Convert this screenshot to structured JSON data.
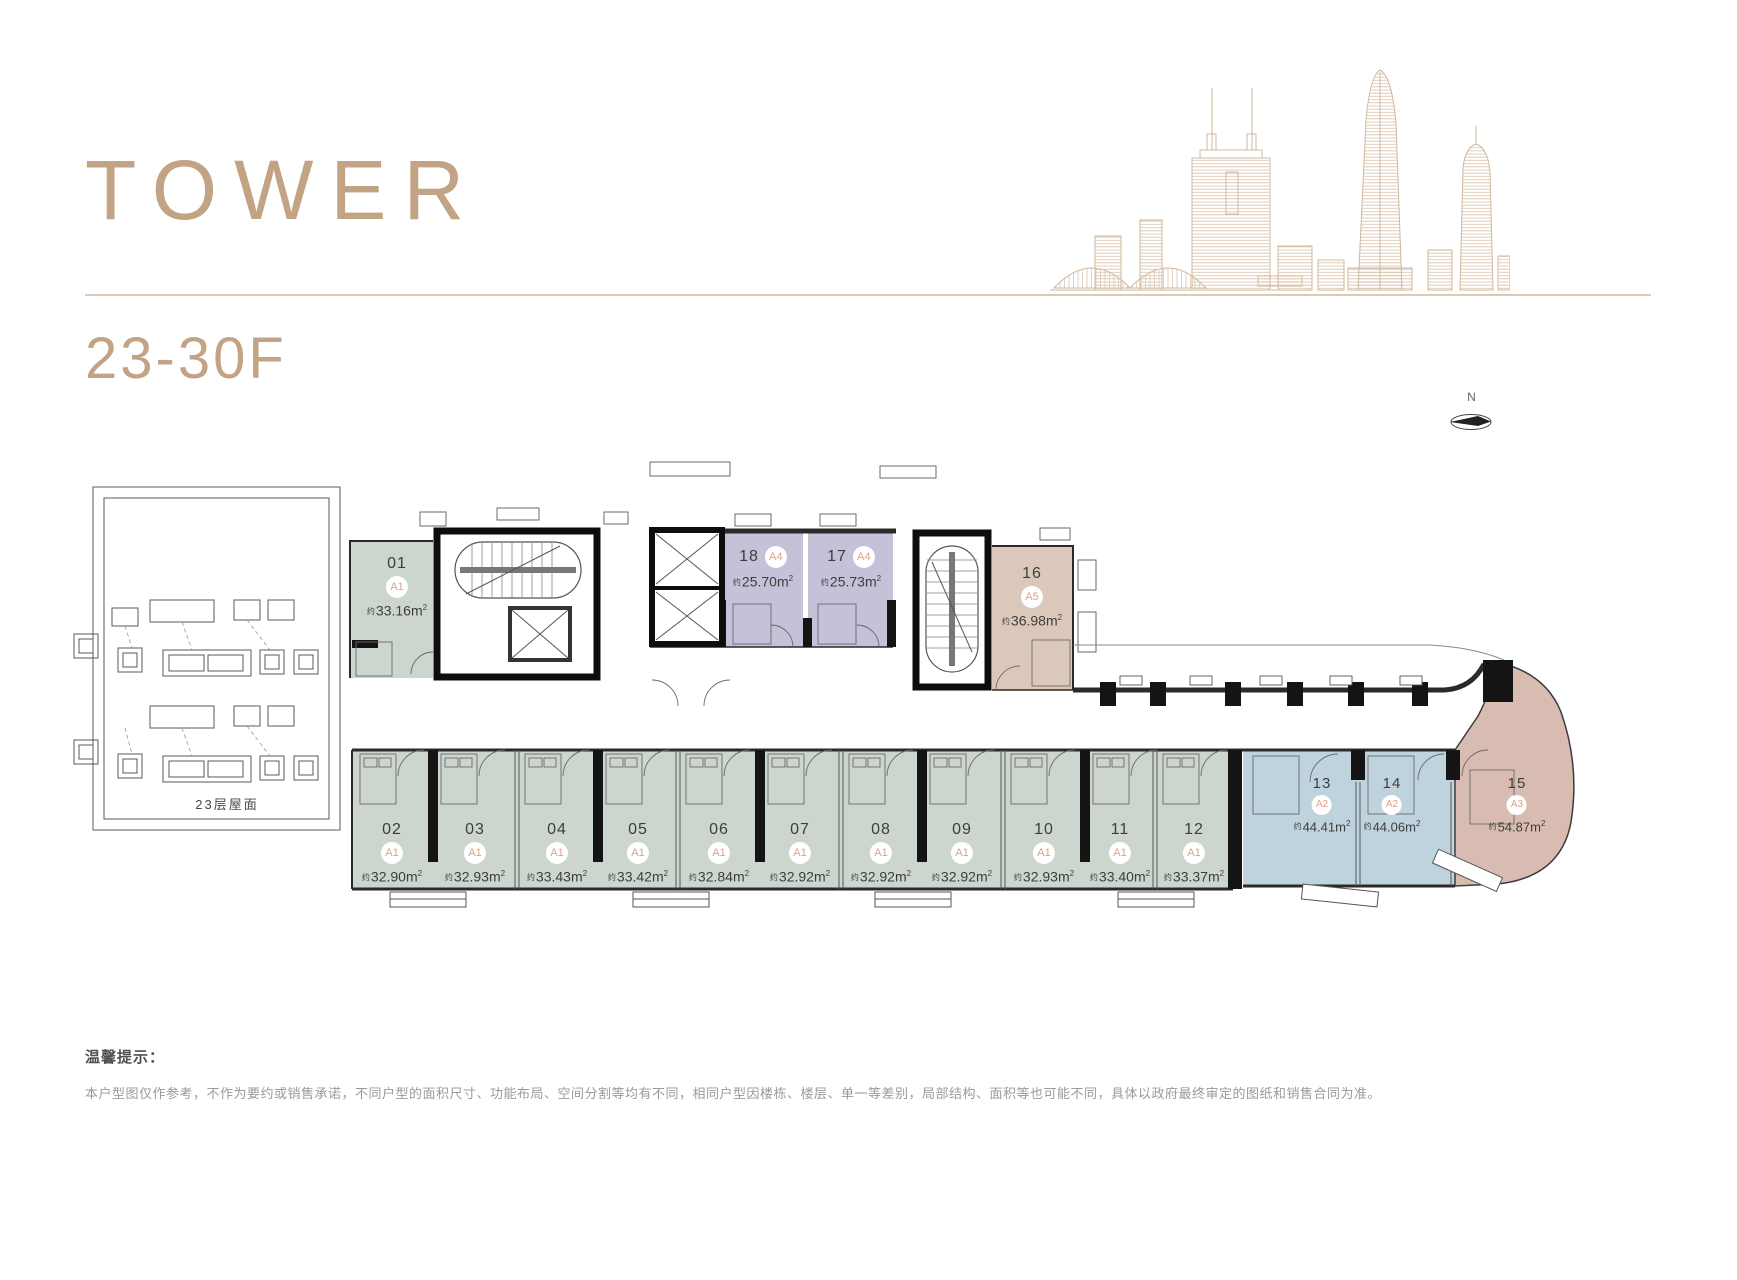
{
  "header": {
    "title": "TOWER",
    "floor_range": "23-30F"
  },
  "compass": {
    "label": "N"
  },
  "roof": {
    "label": "23层屋面"
  },
  "glyphs": {
    "approx": "约",
    "unit_m": "m",
    "sup": "2"
  },
  "units": [
    {
      "no": "01",
      "type": "A1",
      "area": "33.16"
    },
    {
      "no": "02",
      "type": "A1",
      "area": "32.90"
    },
    {
      "no": "03",
      "type": "A1",
      "area": "32.93"
    },
    {
      "no": "04",
      "type": "A1",
      "area": "33.43"
    },
    {
      "no": "05",
      "type": "A1",
      "area": "33.42"
    },
    {
      "no": "06",
      "type": "A1",
      "area": "32.84"
    },
    {
      "no": "07",
      "type": "A1",
      "area": "32.92"
    },
    {
      "no": "08",
      "type": "A1",
      "area": "32.92"
    },
    {
      "no": "09",
      "type": "A1",
      "area": "32.92"
    },
    {
      "no": "10",
      "type": "A1",
      "area": "32.93"
    },
    {
      "no": "11",
      "type": "A1",
      "area": "33.40"
    },
    {
      "no": "12",
      "type": "A1",
      "area": "33.37"
    },
    {
      "no": "13",
      "type": "A2",
      "area": "44.41"
    },
    {
      "no": "14",
      "type": "A2",
      "area": "44.06"
    },
    {
      "no": "15",
      "type": "A3",
      "area": "54.87"
    },
    {
      "no": "16",
      "type": "A5",
      "area": "36.98"
    },
    {
      "no": "17",
      "type": "A4",
      "area": "25.73"
    },
    {
      "no": "18",
      "type": "A4",
      "area": "25.70"
    }
  ],
  "palette": {
    "accent_tan": "#c2a384",
    "badge_text": "#e0a17c",
    "unit_a1_fill": "#ccd6cf",
    "unit_a2_fill": "#bfd3df",
    "unit_a3_fill": "#d8bcb2",
    "unit_a4_fill": "#c3c2d8",
    "unit_a5_fill": "#dcc8ba",
    "skyline_line": "#d0b99f",
    "wall_black": "#111111"
  },
  "notice": {
    "title": "温馨提示：",
    "body": "本户型图仅作参考，不作为要约或销售承诺，不同户型的面积尺寸、功能布局、空间分割等均有不同，相同户型因楼栋、楼层、单一等差别，局部结构、面积等也可能不同，具体以政府最终审定的图纸和销售合同为准。"
  }
}
